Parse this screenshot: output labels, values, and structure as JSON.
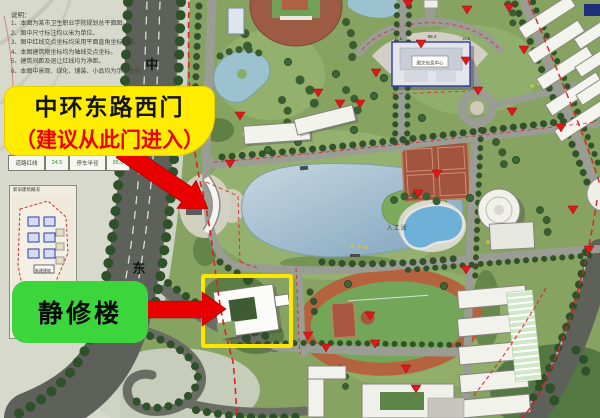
{
  "annotations": {
    "west_gate_callout": {
      "line1": "中环东路西门",
      "line2": "（建议从此门进入）"
    },
    "building_callout": {
      "label": "静修楼"
    }
  },
  "map_labels": {
    "road_char_top": "中",
    "road_char_bottom": "东",
    "lake": "人工湖",
    "library": "图文信息中心",
    "dim_center": "58.4",
    "dim_side": "15.6"
  },
  "notes": {
    "title": "说明：",
    "items": [
      "1、本图为某市卫生职业学院规划总平面图。",
      "2、图中尺寸标注均以米为单位。",
      "3、图中红线交点坐标均采用平面直角坐标系统。",
      "4、本图建筑物坐标均为轴线交点坐标。",
      "5、建筑间距及退让红线均为净距。",
      "6、本图中景观、绿化、铺装、小品均为示意性质。"
    ]
  },
  "stats": {
    "cells": [
      "道路红线",
      "24.5",
      "停车半径",
      "95.5"
    ]
  },
  "inset": {
    "title": "新旧建筑概况",
    "label_new": "新建建筑",
    "label_old": "已建建筑"
  },
  "colors": {
    "highlight_yellow": "#ffec00",
    "highlight_green": "#3cd63c",
    "arrow_red": "#e80000",
    "outline_yellow": "#ffe600"
  }
}
